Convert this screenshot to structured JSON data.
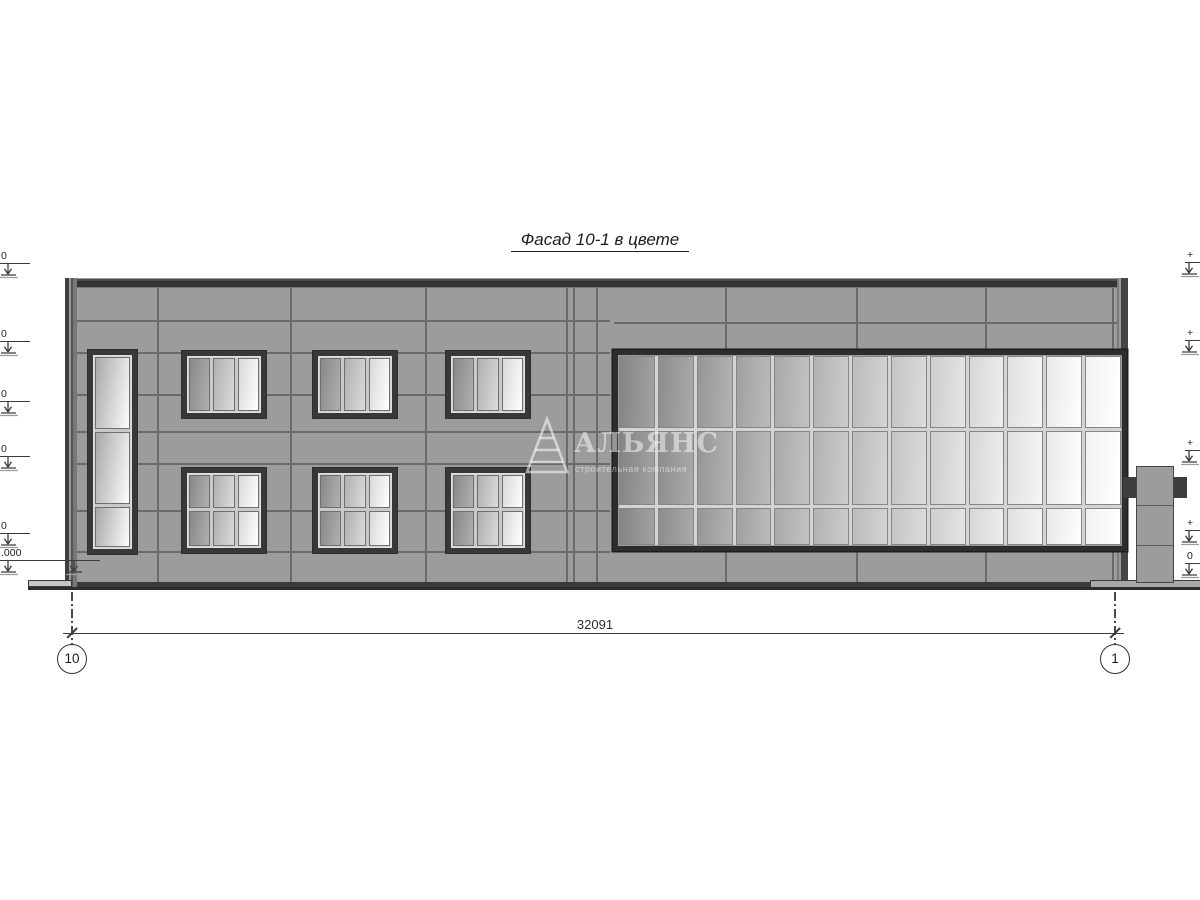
{
  "title": {
    "text": "Фасад 10-1 в цвете"
  },
  "watermark": {
    "name": "АЛЬЯНС",
    "tagline": "строительная компания"
  },
  "dimension": {
    "value": "32091"
  },
  "axes": [
    {
      "label": "10"
    },
    {
      "label": "1"
    }
  ],
  "elevation_markers": {
    "left": [
      {
        "label": "0",
        "y": 264
      },
      {
        "label": "0",
        "y": 342
      },
      {
        "label": "0",
        "y": 402
      },
      {
        "label": "0",
        "y": 457
      },
      {
        "label": "0",
        "y": 534
      },
      {
        "label": ".000",
        "y": 561,
        "wide": true
      }
    ],
    "right": [
      {
        "label": "+",
        "y": 263
      },
      {
        "label": "+",
        "y": 341
      },
      {
        "label": "+",
        "y": 451
      },
      {
        "label": "+",
        "y": 531
      },
      {
        "label": "0",
        "y": 564
      }
    ]
  },
  "colors": {
    "wall": "#9c9c9c",
    "joint": "#6a6a6a",
    "frame": "#3a3a3a",
    "band": "#3b3b3b",
    "ink": "#3c3c3c"
  },
  "facade": {
    "body": {
      "x": 65,
      "y": 278,
      "w": 1063,
      "h": 310
    },
    "joints_h_left": [
      320,
      352,
      394,
      431,
      463,
      510,
      551
    ],
    "joints_h_right": [
      {
        "y": 322,
        "x1": 614,
        "x2": 1119
      }
    ],
    "joints_v_full": [
      157,
      290,
      425,
      566,
      573,
      596
    ],
    "joints_v_bands": [
      725,
      856,
      985,
      1112
    ],
    "windows": [
      {
        "x": 88,
        "y": 350,
        "w": 49,
        "h": 204,
        "cols": 1,
        "rows": [
          0.39,
          0.39,
          0.22
        ]
      },
      {
        "x": 182,
        "y": 351,
        "w": 84,
        "h": 67,
        "cols": 3,
        "rows": [
          1
        ]
      },
      {
        "x": 313,
        "y": 351,
        "w": 84,
        "h": 67,
        "cols": 3,
        "rows": [
          1
        ]
      },
      {
        "x": 446,
        "y": 351,
        "w": 84,
        "h": 67,
        "cols": 3,
        "rows": [
          1
        ]
      },
      {
        "x": 182,
        "y": 468,
        "w": 84,
        "h": 85,
        "cols": 3,
        "rows": [
          0.48,
          0.52
        ]
      },
      {
        "x": 313,
        "y": 468,
        "w": 84,
        "h": 85,
        "cols": 3,
        "rows": [
          0.48,
          0.52
        ]
      },
      {
        "x": 446,
        "y": 468,
        "w": 84,
        "h": 85,
        "cols": 3,
        "rows": [
          0.48,
          0.52
        ]
      }
    ],
    "glazing": {
      "x": 613,
      "y": 350,
      "w": 514,
      "h": 201,
      "cols": 13,
      "rows": [
        0.395,
        0.405,
        0.2
      ]
    },
    "chimney": {
      "x": 1136,
      "y": 466,
      "w": 38,
      "h": 117,
      "divisions": [
        505,
        545
      ],
      "flanks": [
        {
          "x": 1123,
          "y": 477,
          "w": 13,
          "h": 21
        },
        {
          "x": 1174,
          "y": 477,
          "w": 13,
          "h": 21
        }
      ],
      "base": {
        "x": 1090,
        "y": 580,
        "w": 113,
        "h": 8
      }
    },
    "apron": {
      "x": 28,
      "y": 580,
      "w": 44,
      "h": 7
    },
    "ground": {
      "x1": 28,
      "x2": 1205,
      "y": 587
    },
    "dim": {
      "y": 633,
      "x1": 72,
      "x2": 1115
    }
  }
}
